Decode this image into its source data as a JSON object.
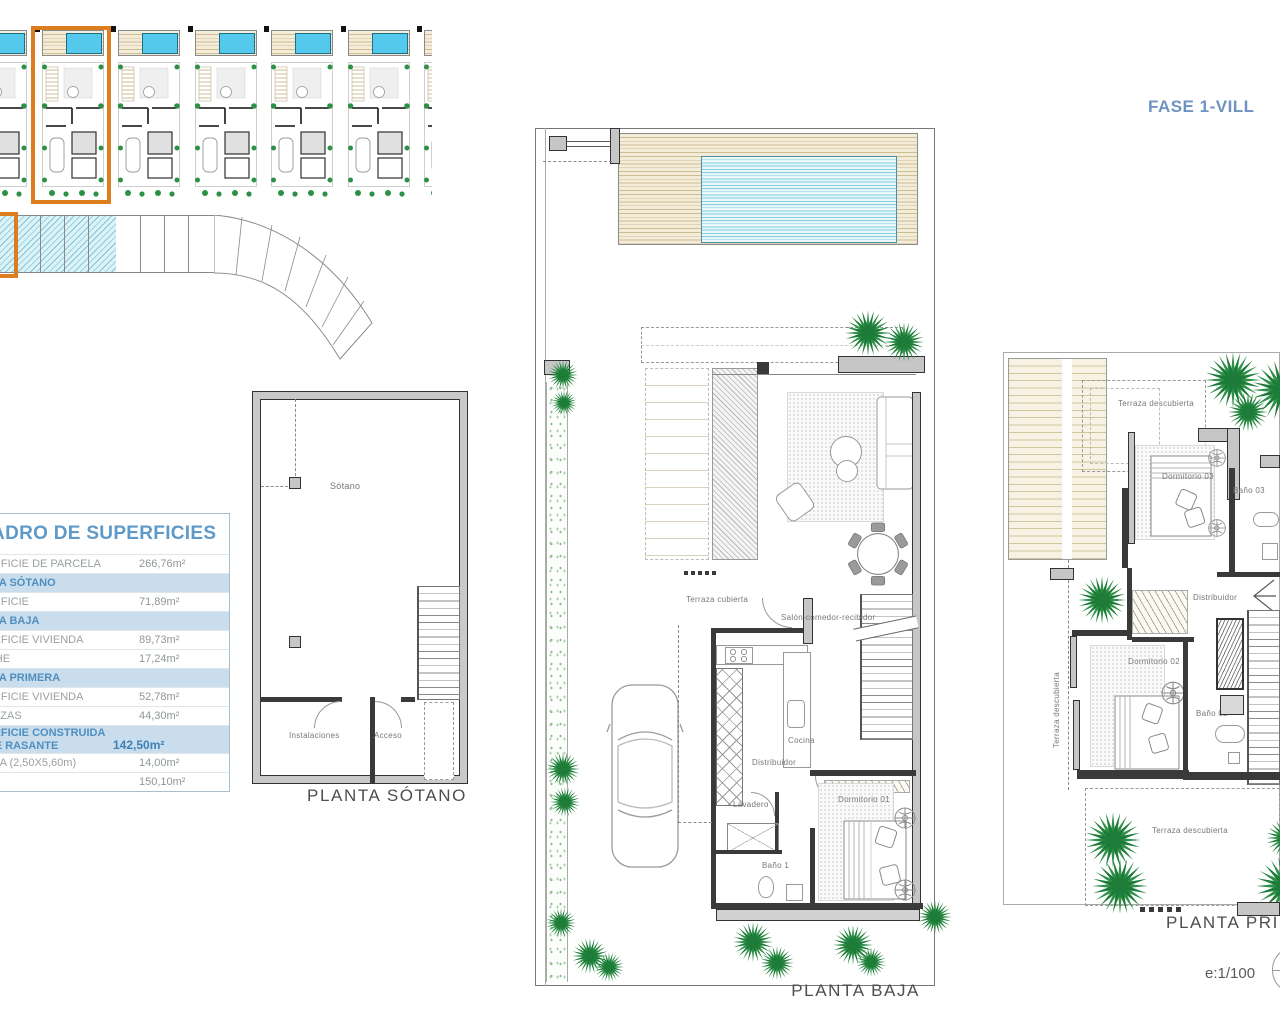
{
  "header": {
    "phase_title": "FASE 1-VILL",
    "scale": "e:1/100"
  },
  "site_plan": {
    "unit_count": 7,
    "highlighted_unit_index": 2
  },
  "areas_table": {
    "title": "CUADRO DE SUPERFICIES",
    "rows": [
      {
        "label": "SUPERFICIE DE PARCELA",
        "value": "266,76m²",
        "type": "data"
      },
      {
        "label": "PLANTA SÓTANO",
        "value": "",
        "type": "header"
      },
      {
        "label": "SUPERFICIE",
        "value": "71,89m²",
        "type": "data"
      },
      {
        "label": "PLANTA BAJA",
        "value": "",
        "type": "header"
      },
      {
        "label": "SUPERFICIE VIVIENDA",
        "value": "89,73m²",
        "type": "data"
      },
      {
        "label": "PORCHE",
        "value": "17,24m²",
        "type": "data"
      },
      {
        "label": "PLANTA PRIMERA",
        "value": "",
        "type": "header"
      },
      {
        "label": "SUPERFICIE VIVIENDA",
        "value": "52,78m²",
        "type": "data"
      },
      {
        "label": "TERRAZAS",
        "value": "44,30m²",
        "type": "data"
      },
      {
        "label": "SUPERFICIE CONSTRUIDA SOBRE RASANTE",
        "value": "142,50m²",
        "type": "total"
      },
      {
        "label": "PISCINA (2,50X5,60m)",
        "value": "14,00m²",
        "type": "data"
      },
      {
        "label": "",
        "value": "150,10m²",
        "type": "data"
      }
    ]
  },
  "plans": {
    "sotano": {
      "title": "PLANTA SÓTANO",
      "rooms": {
        "sotano": "Sótano",
        "instalaciones": "Instalaciones",
        "acceso": "Acceso"
      }
    },
    "baja": {
      "title": "PLANTA BAJA",
      "rooms": {
        "terraza_cubierta": "Terraza cubierta",
        "salon": "Salón-comedor-recibidor",
        "cocina": "Cocina",
        "distribuidor": "Distribuidor",
        "lavadero": "Lavadero",
        "dormitorio1": "Dormitorio 01",
        "bano1": "Baño 1"
      }
    },
    "primera": {
      "title": "PLANTA PRIMERA",
      "rooms": {
        "terraza_top": "Terraza descubierta",
        "dormitorio3": "Dormitorio 03",
        "bano3": "Baño 03",
        "distribuidor": "Distribuidor",
        "dormitorio2": "Dormitorio 02",
        "bano2": "Baño 02",
        "terraza_left": "Terraza descubierta",
        "terraza_bottom": "Terraza descubierta"
      }
    }
  },
  "icons": {
    "tree": "starburst-palm",
    "north_indicator": "circle-with-line"
  },
  "colors": {
    "highlight_orange": "#DD7E1E",
    "pool_cyan": "#55C9EC",
    "table_blue": "#5E9AC9",
    "tree_green": "#2E9049"
  }
}
